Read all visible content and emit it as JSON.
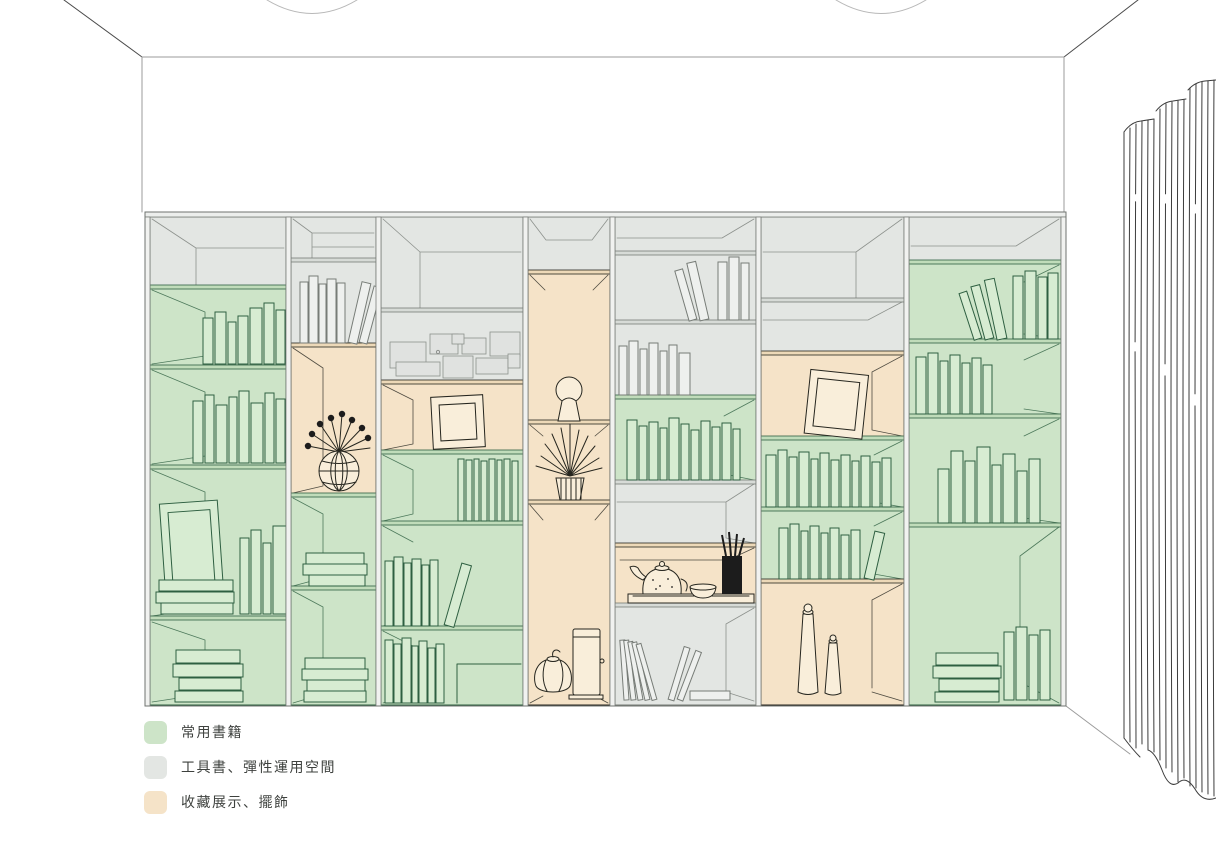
{
  "legend": {
    "items": [
      {
        "id": "books",
        "label": "常用書籍",
        "color": "#cde4c8"
      },
      {
        "id": "flex",
        "label": "工具書、彈性運用空間",
        "color": "#e3e6e3"
      },
      {
        "id": "display",
        "label": "收藏展示、擺飾",
        "color": "#f5e3c8"
      }
    ]
  },
  "colors": {
    "background": "#ffffff",
    "line_green": "#2e5f41",
    "line_flex": "#777c77",
    "line_dark": "#26261f",
    "line_wall": "#9b9b9b",
    "book_green_fill": "#d7ecd2",
    "book_flex_fill": "#eef0ee",
    "display_item_fill": "#f9eeda",
    "paper_fill": "#e0e2e0",
    "board_green": "#c0dcba",
    "board_flex": "#d7dbd7",
    "board_display": "#edd9b8",
    "curtain_line": "#3c3c3c",
    "text": "#3e413e"
  },
  "scene": {
    "type": "interior-elevation-illustration",
    "room": {
      "walls": "white",
      "ceiling_light_count": 2,
      "curtain": "floor-length curtain on right side"
    },
    "bookshelf": {
      "column_count": 7,
      "zones_key": {
        "books": "常用書籍",
        "flex": "工具書、彈性運用空間",
        "display": "收藏展示、擺飾"
      },
      "columns": [
        {
          "cells": [
            {
              "zone": "flex",
              "content": "empty"
            },
            {
              "zone": "books",
              "content": "standing-books"
            },
            {
              "zone": "books",
              "content": "standing-books"
            },
            {
              "zone": "books",
              "content": "picture-frame, stacked-books, standing-books"
            },
            {
              "zone": "books",
              "content": "stacked-books"
            }
          ]
        },
        {
          "cells": [
            {
              "zone": "flex",
              "content": "empty"
            },
            {
              "zone": "flex",
              "content": "standing-and-leaning-books"
            },
            {
              "zone": "display",
              "content": "flower-vase"
            },
            {
              "zone": "books",
              "content": "stacked-books"
            },
            {
              "zone": "books",
              "content": "stacked-books"
            }
          ]
        },
        {
          "cells": [
            {
              "zone": "flex",
              "content": "empty"
            },
            {
              "zone": "flex",
              "content": "mood-board-notes"
            },
            {
              "zone": "display",
              "content": "picture-frame"
            },
            {
              "zone": "books",
              "content": "thin-standing-books"
            },
            {
              "zone": "books",
              "content": "standing-books, leaning-book"
            },
            {
              "zone": "books",
              "content": "standing-books"
            }
          ]
        },
        {
          "cells": [
            {
              "zone": "flex",
              "content": "empty"
            },
            {
              "zone": "display",
              "content": "sculpture"
            },
            {
              "zone": "display",
              "content": "potted-plant"
            },
            {
              "zone": "display",
              "content": "floor-lamp, gourd-ornament"
            }
          ]
        },
        {
          "cells": [
            {
              "zone": "flex",
              "content": "empty"
            },
            {
              "zone": "flex",
              "content": "leaning-books"
            },
            {
              "zone": "flex",
              "content": "standing-books"
            },
            {
              "zone": "books",
              "content": "standing-books"
            },
            {
              "zone": "flex",
              "content": "empty"
            },
            {
              "zone": "display",
              "content": "tea-set-on-tray"
            },
            {
              "zone": "flex",
              "content": "leaning-books, flat-book"
            }
          ]
        },
        {
          "cells": [
            {
              "zone": "flex",
              "content": "empty"
            },
            {
              "zone": "flex",
              "content": "empty"
            },
            {
              "zone": "display",
              "content": "leaning-picture-frame"
            },
            {
              "zone": "books",
              "content": "standing-books"
            },
            {
              "zone": "books",
              "content": "standing-books"
            },
            {
              "zone": "display",
              "content": "two-tall-vases"
            }
          ]
        },
        {
          "cells": [
            {
              "zone": "flex",
              "content": "empty"
            },
            {
              "zone": "books",
              "content": "leaning-books"
            },
            {
              "zone": "books",
              "content": "standing-books"
            },
            {
              "zone": "books",
              "content": "book-cluster"
            },
            {
              "zone": "books",
              "content": "stacked-books, standing-books"
            }
          ]
        }
      ]
    }
  }
}
